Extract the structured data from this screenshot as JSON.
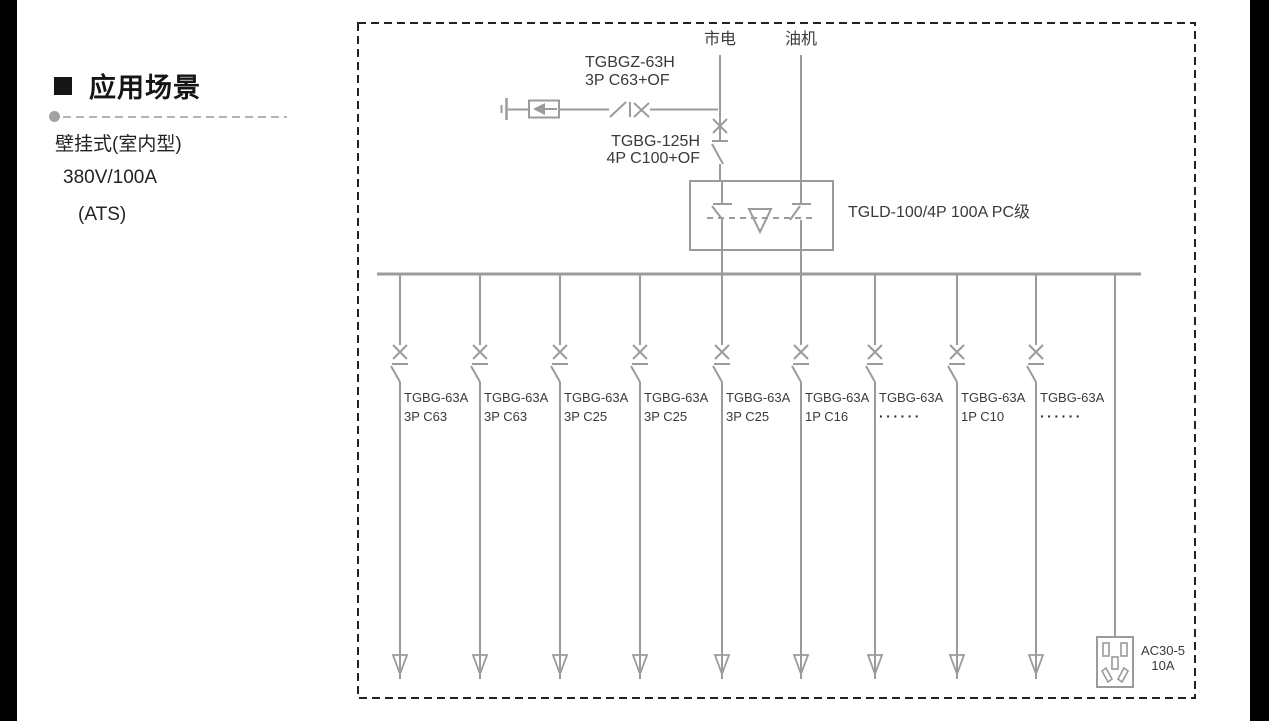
{
  "sidebar": {
    "bullet_icon": "black-square",
    "heading": "应用场景",
    "lines": [
      "壁挂式(室内型)",
      "380V/100A",
      "(ATS)"
    ]
  },
  "diagram": {
    "source_left": "市电",
    "source_right": "油机",
    "spd_breaker_model": "TGBGZ-63H",
    "spd_breaker_spec": "3P C63+OF",
    "main_breaker_model": "TGBG-125H",
    "main_breaker_spec": "4P C100+OF",
    "ats_label": "TGLD-100/4P 100A PC级",
    "feeders": [
      {
        "x": 400,
        "model": "TGBG-63A",
        "spec": "3P C63"
      },
      {
        "x": 480,
        "model": "TGBG-63A",
        "spec": "3P C63"
      },
      {
        "x": 560,
        "model": "TGBG-63A",
        "spec": "3P C25"
      },
      {
        "x": 640,
        "model": "TGBG-63A",
        "spec": "3P C25"
      },
      {
        "x": 722,
        "model": "TGBG-63A",
        "spec": "3P C25"
      },
      {
        "x": 801,
        "model": "TGBG-63A",
        "spec": "1P C16"
      },
      {
        "x": 875,
        "model": "TGBG-63A",
        "spec": "······"
      },
      {
        "x": 957,
        "model": "TGBG-63A",
        "spec": "1P C10"
      },
      {
        "x": 1036,
        "model": "TGBG-63A",
        "spec": "······"
      }
    ],
    "socket_model": "AC30-5",
    "socket_rating": "10A",
    "colors": {
      "line": "#9b9b9b",
      "text": "#3a3a3a",
      "border": "#222222"
    }
  }
}
